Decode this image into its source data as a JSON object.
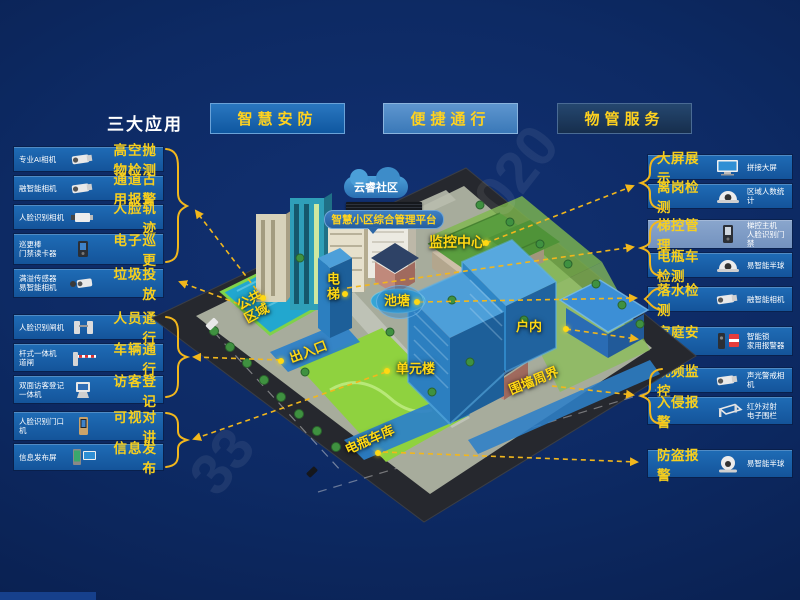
{
  "header": {
    "title": "三大应用",
    "buttons": [
      {
        "label": "智慧安防"
      },
      {
        "label": "便捷通行"
      },
      {
        "label": "物管服务"
      }
    ]
  },
  "left_groups": [
    {
      "items": [
        {
          "device": "专业AI相机",
          "feature": "高空抛物检测",
          "icon": "bullet-camera"
        },
        {
          "device": "融智能相机",
          "feature": "通道占用报警",
          "icon": "bullet-camera"
        },
        {
          "device": "人脸识别相机",
          "feature": "人脸轨迹",
          "icon": "box-camera"
        },
        {
          "device": "巡更棒\n门禁读卡器",
          "feature": "电子巡更",
          "icon": "access-reader"
        },
        {
          "device": "满溢传感器\n易智能相机",
          "feature": "垃圾投放",
          "icon": "bullet-camera"
        }
      ]
    },
    {
      "items": [
        {
          "device": "人脸识别闸机",
          "feature": "人员通行",
          "icon": "turnstile"
        },
        {
          "device": "杆式一体机\n道闸",
          "feature": "车辆通行",
          "icon": "barrier-gate"
        },
        {
          "device": "双面访客登记\n一体机",
          "feature": "访客登记",
          "icon": "visitor-kiosk"
        }
      ]
    },
    {
      "items": [
        {
          "device": "人脸识别门口机",
          "feature": "可视对讲",
          "icon": "door-station"
        },
        {
          "device": "信息发布屏",
          "feature": "信息发布",
          "icon": "signage-screen"
        }
      ]
    }
  ],
  "right_groups": [
    {
      "items": [
        {
          "feature": "大屏展示",
          "device": "拼接大屏",
          "icon": "video-wall"
        },
        {
          "feature": "离岗检测",
          "device": "区域人数统计",
          "icon": "dome-camera"
        }
      ]
    },
    {
      "items": [
        {
          "feature": "梯控管理",
          "device": "梯控主机\n人脸识别门禁",
          "icon": "elevator-panel",
          "highlight": true
        },
        {
          "feature": "电瓶车检测",
          "device": "易智能半球",
          "icon": "dome-camera"
        }
      ]
    },
    {
      "items": [
        {
          "feature": "落水检测",
          "device": "融智能相机",
          "icon": "bullet-camera"
        }
      ]
    },
    {
      "items": [
        {
          "feature": "家庭安防",
          "device": "智能锁\n家用报警器",
          "icon": "lock-siren"
        }
      ]
    },
    {
      "items": [
        {
          "feature": "视频监控",
          "device": "声光警戒相机",
          "icon": "bullet-camera"
        },
        {
          "feature": "入侵报警",
          "device": "红外对射\n电子围栏",
          "icon": "perimeter-fence"
        }
      ]
    },
    {
      "items": [
        {
          "feature": "防盗报警",
          "device": "易智能半球",
          "icon": "turret-camera"
        }
      ]
    }
  ],
  "map": {
    "cloud_label": "云睿社区",
    "platform_label": "智慧小区综合管理平台",
    "zones": {
      "monitor_center": "监控中心",
      "elevator": "电梯",
      "pond": "池塘",
      "public_area": "公共区域",
      "entrance": "出入口",
      "unit_building": "单元楼",
      "indoor": "户内",
      "perimeter": "围墙周界",
      "ebike_garage": "电瓶车库"
    }
  },
  "watermark": {
    "upper": "020",
    "lower": "33"
  },
  "colors": {
    "background": "#0d2a64",
    "row_blue": "#1765b0",
    "row_highlight": "#7f9fca",
    "accent_yellow": "#f7cf1d",
    "button_active": "#1467b2",
    "button_light": "#4886c5",
    "button_dark": "#1d3a5f"
  }
}
